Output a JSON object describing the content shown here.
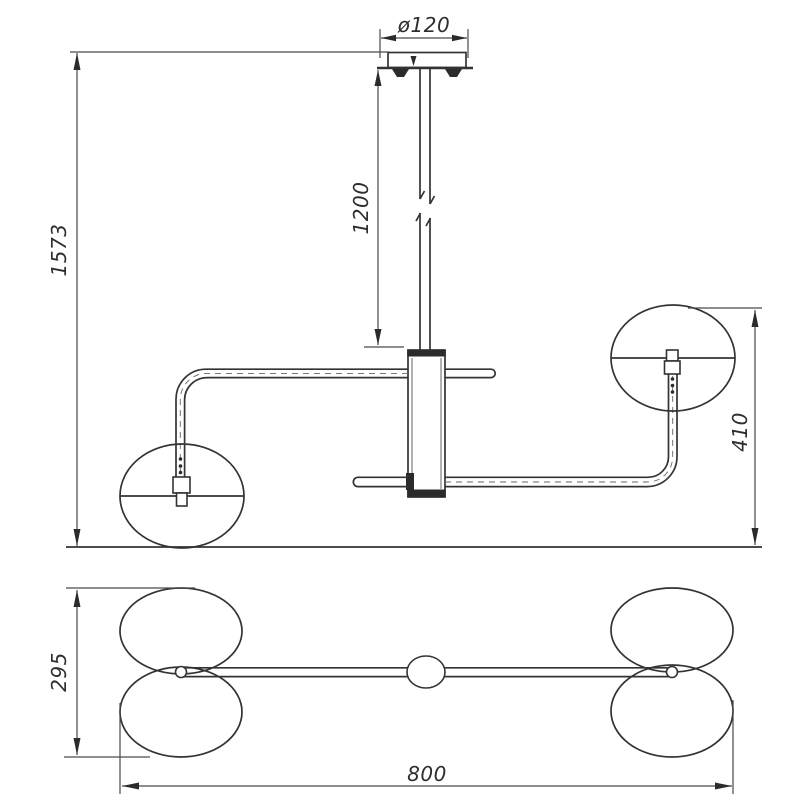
{
  "drawing": {
    "title": "pendant-chandelier-dimension-drawing",
    "views": {
      "front_view": "front elevation",
      "plan_view": "plan view"
    },
    "dimensions": {
      "canopy_diameter": "ø120",
      "rod_length": "1200",
      "overall_height": "1573",
      "arm_drop": "410",
      "plan_depth": "295",
      "plan_width": "800"
    },
    "colors": {
      "background": "#ffffff",
      "line": "#333333"
    }
  }
}
